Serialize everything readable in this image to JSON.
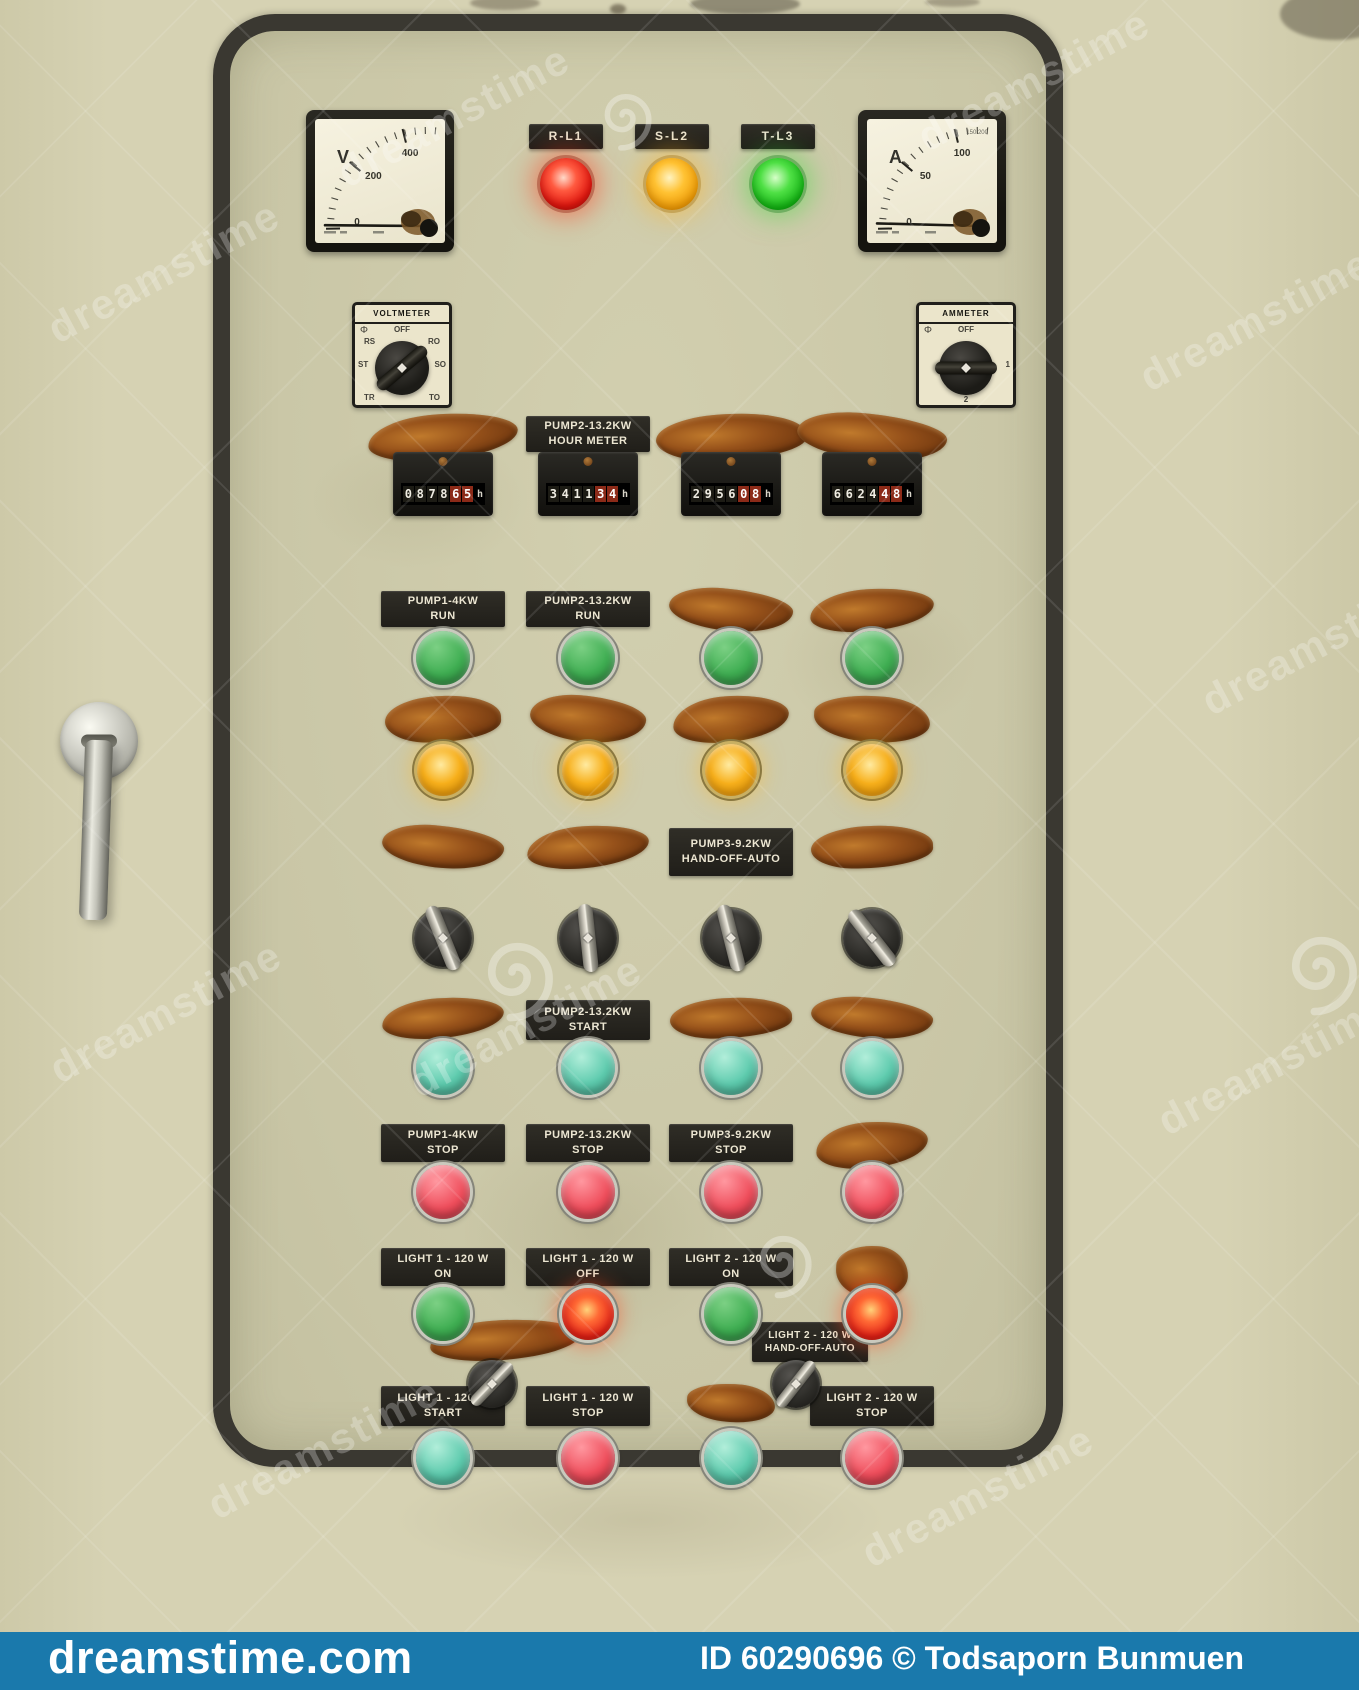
{
  "brand": {
    "watermark_text": "dreamstime",
    "site": "dreamstime.com",
    "credit": "ID 60290696 © Todsaporn Bunmuen",
    "bar_color": "#1a79ac"
  },
  "meters": {
    "voltmeter": {
      "unit": "V",
      "tick_labels": [
        "0",
        "200",
        "400"
      ],
      "needle_angle": 179
    },
    "ammeter": {
      "unit": "A",
      "tick_labels": [
        "0",
        "50",
        "100"
      ],
      "corner_text": "150 200",
      "needle_angle": 178
    }
  },
  "phase_indicators": [
    {
      "label": "R-L1",
      "tone": "red",
      "color": "#e31b12"
    },
    {
      "label": "S-L2",
      "tone": "amber",
      "color": "#f2a60d"
    },
    {
      "label": "T-L3",
      "tone": "green",
      "color": "#17b517"
    }
  ],
  "selectors": [
    {
      "title": "VOLTMETER",
      "symbol": "Φ",
      "knob_angle": 50,
      "positions": [
        {
          "label": "OFF",
          "slot": "top"
        },
        {
          "label": "RS",
          "slot": "upper-left"
        },
        {
          "label": "RO",
          "slot": "upper-right"
        },
        {
          "label": "ST",
          "slot": "left"
        },
        {
          "label": "SO",
          "slot": "right"
        },
        {
          "label": "TR",
          "slot": "bottom-left"
        },
        {
          "label": "TO",
          "slot": "bottom-right"
        }
      ]
    },
    {
      "title": "AMMETER",
      "symbol": "Φ",
      "knob_angle": 90,
      "positions": [
        {
          "label": "OFF",
          "slot": "top"
        },
        {
          "label": "1",
          "slot": "right"
        },
        {
          "label": "2",
          "slot": "bottom"
        }
      ]
    }
  ],
  "hour_meter_unit": "h",
  "panel_rows": [
    {
      "id": "hour-meter",
      "control": "counter",
      "cells": [
        {
          "label": null,
          "value": "087865"
        },
        {
          "label": [
            "PUMP2-13.2KW",
            "HOUR METER"
          ],
          "value": "341134"
        },
        {
          "label": null,
          "value": "295608"
        },
        {
          "label": null,
          "value": "662448"
        }
      ]
    },
    {
      "id": "run",
      "control": "button-green",
      "cells": [
        {
          "label": [
            "PUMP1-4KW",
            "RUN"
          ]
        },
        {
          "label": [
            "PUMP2-13.2KW",
            "RUN"
          ]
        },
        {
          "label": null
        },
        {
          "label": null
        }
      ]
    },
    {
      "id": "pilot",
      "control": "light-amber",
      "cells": [
        {
          "label": null
        },
        {
          "label": null
        },
        {
          "label": null
        },
        {
          "label": null
        }
      ]
    },
    {
      "id": "hand-off-auto",
      "control": "knob",
      "cells": [
        {
          "label": null
        },
        {
          "label": null
        },
        {
          "label": [
            "PUMP3-9.2KW",
            "HAND-OFF-AUTO"
          ]
        },
        {
          "label": null
        }
      ]
    },
    {
      "id": "start",
      "control": "button-cyan",
      "cells": [
        {
          "label": null
        },
        {
          "label": [
            "PUMP2-13.2KW",
            "START"
          ]
        },
        {
          "label": null
        },
        {
          "label": null
        }
      ]
    },
    {
      "id": "stop",
      "control": "button-red",
      "cells": [
        {
          "label": [
            "PUMP1-4KW",
            "STOP"
          ]
        },
        {
          "label": [
            "PUMP2-13.2KW",
            "STOP"
          ]
        },
        {
          "label": [
            "PUMP3-9.2KW",
            "STOP"
          ]
        },
        {
          "label": null
        }
      ]
    },
    {
      "id": "light-on-off",
      "control": "button-green",
      "cells": [
        {
          "label": [
            "LIGHT 1 - 120 W",
            "ON"
          ],
          "control": "button-green"
        },
        {
          "label": [
            "LIGHT 1 - 120 W",
            "OFF"
          ],
          "control": "light-red"
        },
        {
          "label": [
            "LIGHT 2 - 120 W",
            "ON"
          ],
          "control": "button-green"
        },
        {
          "label": null,
          "control": "light-red"
        }
      ]
    },
    {
      "id": "light-start-stop",
      "control": "button-cyan",
      "cells": [
        {
          "label": [
            "LIGHT 1 - 120 W",
            "START"
          ],
          "control": "button-cyan"
        },
        {
          "label": [
            "LIGHT 1 - 120 W",
            "STOP"
          ],
          "control": "button-red"
        },
        {
          "label": null,
          "control": "button-cyan"
        },
        {
          "label": [
            "LIGHT 2 - 120 W",
            "STOP"
          ],
          "control": "button-red"
        }
      ]
    }
  ],
  "aux_hand_off_auto": [
    {
      "label": null
    },
    {
      "label": [
        "LIGHT 2 - 120 W",
        "HAND-OFF-AUTO"
      ]
    }
  ]
}
